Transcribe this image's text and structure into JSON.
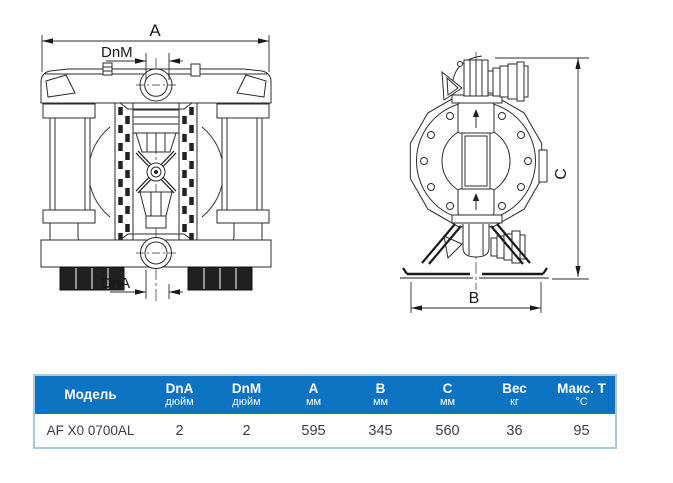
{
  "drawing": {
    "labels": {
      "dim_a": "A",
      "dim_dnm": "DnM",
      "dim_dna": "DnA",
      "dim_b": "B",
      "dim_c": "C"
    }
  },
  "table": {
    "header_bg": "#0c72c2",
    "border_color": "#a6c9e8",
    "columns": [
      {
        "label": "Модель",
        "unit": ""
      },
      {
        "label": "DnA",
        "unit": "дюйм"
      },
      {
        "label": "DnM",
        "unit": "дюйм"
      },
      {
        "label": "A",
        "unit": "мм"
      },
      {
        "label": "B",
        "unit": "мм"
      },
      {
        "label": "C",
        "unit": "мм"
      },
      {
        "label": "Вес",
        "unit": "кг"
      },
      {
        "label": "Макс. T",
        "unit": "°C"
      }
    ],
    "rows": [
      {
        "model": "AF X0 0700AL",
        "dna": "2",
        "dnm": "2",
        "a": "595",
        "b": "345",
        "c": "560",
        "weight": "36",
        "max_t": "95"
      }
    ]
  }
}
